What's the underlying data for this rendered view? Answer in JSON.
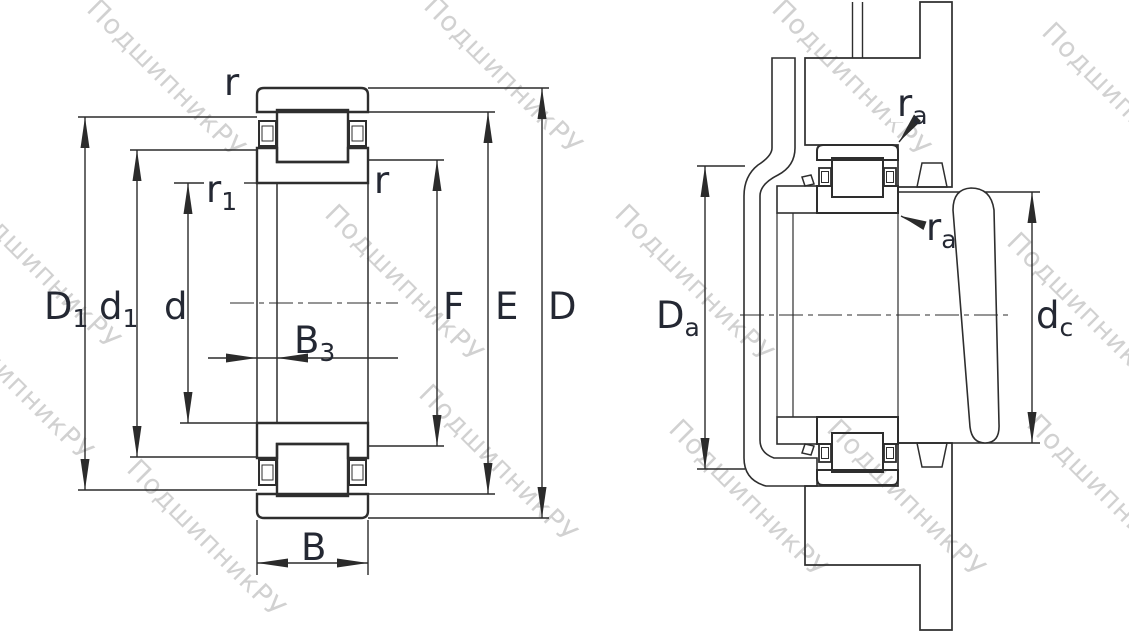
{
  "watermark": {
    "text": "ПодшипникРУ"
  },
  "colors": {
    "background": "#ffffff",
    "line": "#2e2e2e",
    "dimension_line": "#2b2b2b",
    "label": "#242833",
    "watermark": "#c6c6c6"
  },
  "left_view": {
    "title": "bearing-cross-section",
    "labels": {
      "r_top": "r",
      "r_side": "r",
      "r1": {
        "main": "r",
        "sub": "1"
      },
      "D1": {
        "main": "D",
        "sub": "1"
      },
      "d1": {
        "main": "d",
        "sub": "1"
      },
      "d": "d",
      "F": "F",
      "E": "E",
      "D": "D",
      "B3": {
        "main": "B",
        "sub": "3"
      },
      "B": "B"
    }
  },
  "right_view": {
    "title": "mounted-bearing-abutment",
    "labels": {
      "ra_top": {
        "main": "r",
        "sub": "a"
      },
      "ra_bottom": {
        "main": "r",
        "sub": "a"
      },
      "Da": {
        "main": "D",
        "sub": "a"
      },
      "dc": {
        "main": "d",
        "sub": "c"
      }
    }
  }
}
